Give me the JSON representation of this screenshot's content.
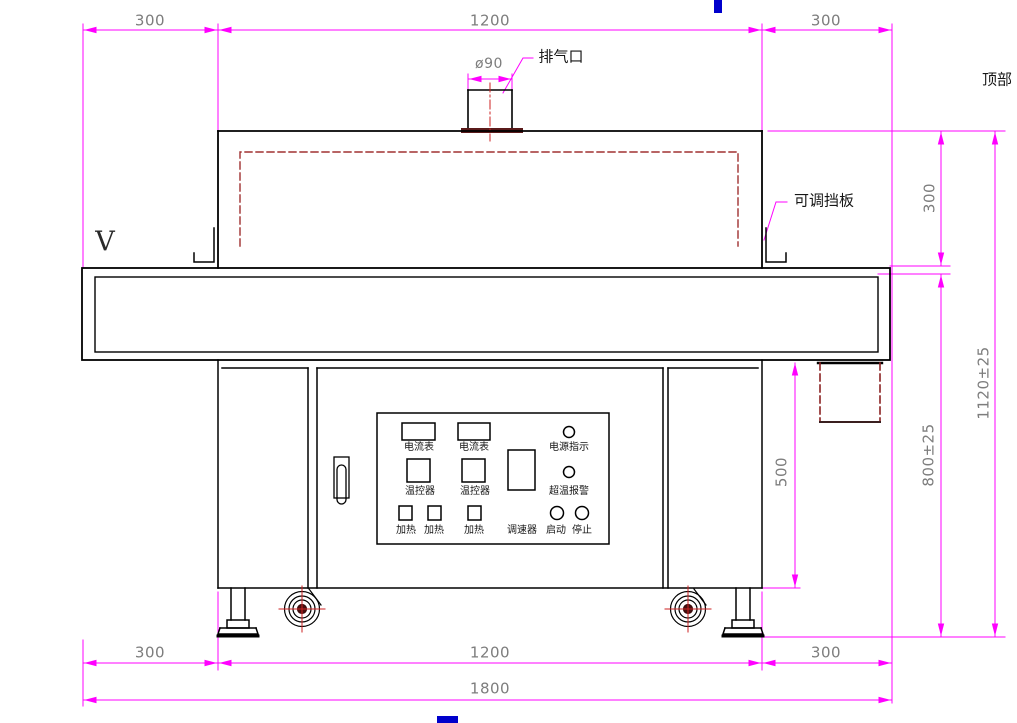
{
  "drawing": {
    "type": "engineering-drawing",
    "subject": "tunnel-oven-front-elevation",
    "colors": {
      "dimension_line": "#ff00ff",
      "dimension_text": "#7d7d7d",
      "outline": "#000000",
      "hidden_line_red": "#a03030",
      "centerline_red": "#cc2222",
      "flange_dark_red": "#5a1a1a",
      "cursor_mark_blue": "#0000cc",
      "background": "#ffffff"
    }
  },
  "dimensions": {
    "top": {
      "left": "300",
      "center": "1200",
      "right": "300"
    },
    "exhaust_diameter": "ø90",
    "right_side": {
      "tunnel_height": "300",
      "overall_height": "1120±25",
      "work_surface_height": "800±25",
      "cabinet_height": "500"
    },
    "bottom": {
      "left": "300",
      "center": "1200",
      "right": "300",
      "overall": "1800"
    }
  },
  "labels": {
    "exhaust_port": "排气口",
    "top_marker": "顶部",
    "adjustable_baffle": "可调挡板",
    "view_marker": "V"
  },
  "control_panel": {
    "ammeter_1": "电流表",
    "ammeter_2": "电流表",
    "power_indicator": "电源指示",
    "temp_controller_1": "温控器",
    "temp_controller_2": "温控器",
    "overtemp_alarm": "超温报警",
    "heater_1": "加热",
    "heater_2": "加热",
    "heater_3": "加热",
    "speed_controller": "调速器",
    "start": "启动",
    "stop": "停止"
  }
}
